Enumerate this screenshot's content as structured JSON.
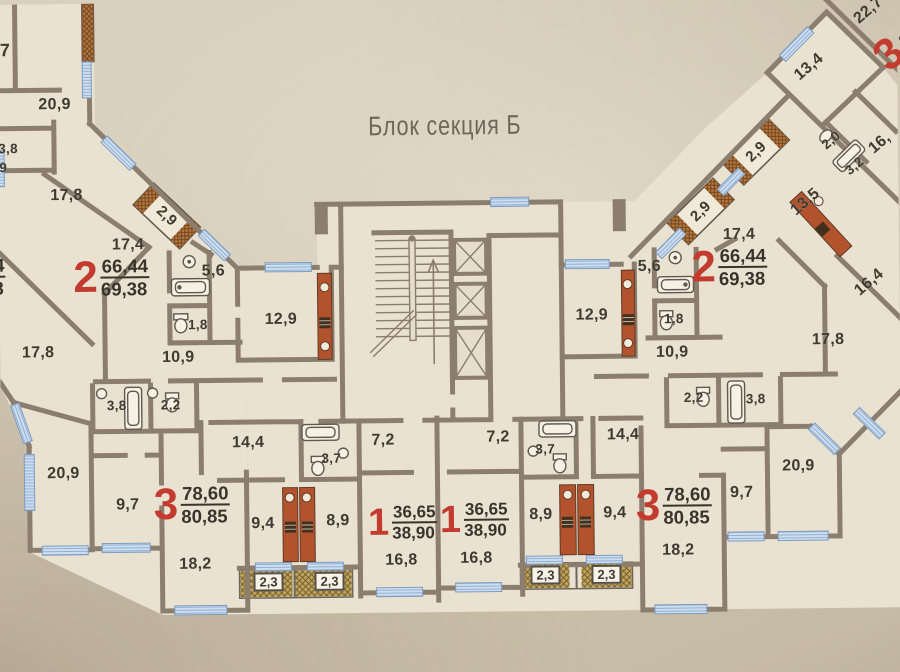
{
  "title": "Блок секция Б",
  "colors": {
    "accent-red": "#c23b2e",
    "wall": "#8b7e6e",
    "window-blue": "#cfdeed",
    "shaft-red": "#b2532e",
    "room": "#eae2d1"
  },
  "apartments": {
    "left2": {
      "num": "2",
      "a1": "66,44",
      "a2": "69,38"
    },
    "right2": {
      "num": "2",
      "a1": "66,44",
      "a2": "69,38"
    },
    "left3": {
      "num": "3",
      "a1": "78,60",
      "a2": "80,85"
    },
    "right3": {
      "num": "3",
      "a1": "78,60",
      "a2": "80,85"
    },
    "left1": {
      "num": "1",
      "a1": "36,65",
      "a2": "38,90"
    },
    "right1": {
      "num": "1",
      "a1": "36,65",
      "a2": "38,90"
    },
    "edge_left": {
      "a1": "66,44",
      "a2": "69,38"
    },
    "top_right": {
      "num": "3",
      "a1": "8"
    }
  },
  "rooms": {
    "adj_7": "7",
    "adj_20_9": "20,9",
    "adj_3_8": "3,8",
    "adj_9": "9",
    "adj_17_8": "17,8",
    "l2_2_9": "2,9",
    "l2_17_4": "17,4",
    "l2_5_6": "5,6",
    "l2_1_8": "1,8",
    "l2_12_9": "12,9",
    "l2_10_9": "10,9",
    "l2_17_8": "17,8",
    "l3_3_8": "3,8",
    "l3_2_2": "2,2",
    "l3_14_4": "14,4",
    "l3_3_7": "3,7",
    "l3_20_9": "20,9",
    "l3_9_7": "9,7",
    "l3_9_4": "9,4",
    "l3_18_2": "18,2",
    "l3_2_3": "2,3",
    "l1_7_2": "7,2",
    "l1_16_8": "16,8",
    "l1_8_9": "8,9",
    "l1_2_3": "2,3",
    "r1_7_2": "7,2",
    "r1_16_8": "16,8",
    "r1_8_9": "8,9",
    "r1_3_7": "3,7",
    "r1_2_3": "2,3",
    "r3_2_3": "2,3",
    "r3_9_4": "9,4",
    "r3_18_2": "18,2",
    "r3_9_7": "9,7",
    "r3_20_9": "20,9",
    "r3_14_4": "14,4",
    "r3_2_2": "2,2",
    "r3_3_8": "3,8",
    "r2_12_9": "12,9",
    "r2_1_8": "1,8",
    "r2_10_9": "10,9",
    "r2_5_6": "5,6",
    "r2_17_4": "17,4",
    "r2_2_9": "2,9",
    "r2_17_8": "17,8",
    "rw_2_9": "2,9",
    "rw_13_5": "13,5",
    "rw_13_4": "13,4",
    "rw_22_7": "22,7",
    "rw_2_0": "2,0",
    "rw_3_2": "3,2",
    "rw_16": "16,",
    "rw_16_4": "16,4"
  }
}
